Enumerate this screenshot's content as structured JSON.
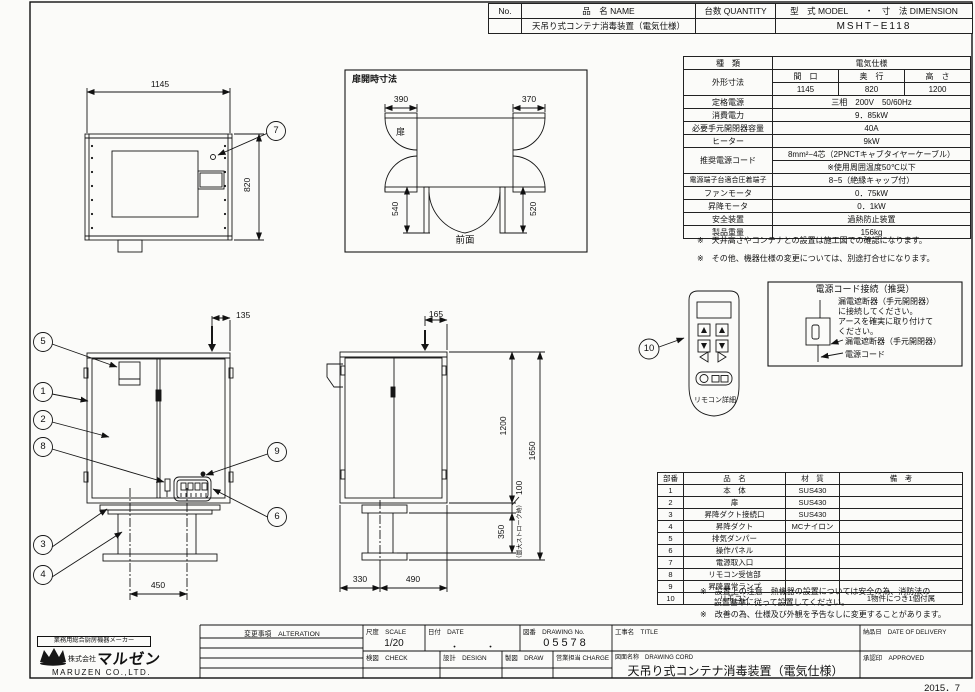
{
  "header": {
    "no_label": "No.",
    "name_label": "品　名 NAME",
    "name_value": "天吊り式コンテナ消毒装置（電気仕様）",
    "qty_label": "台数 QUANTITY",
    "model_label": "型　式 MODEL　　・　寸　法 DIMENSION",
    "model_value": "MSHT−E118"
  },
  "spec": {
    "kind_label": "種　類",
    "kind_value": "電気仕様",
    "size_label": "外形寸法",
    "size_cols": [
      "間　口",
      "奥　行",
      "高　さ"
    ],
    "size_values": [
      "1145",
      "820",
      "1200"
    ],
    "rows": [
      {
        "label": "定格電源",
        "value": "三相　200V　50/60Hz"
      },
      {
        "label": "消費電力",
        "value": "9．85kW"
      },
      {
        "label": "必要手元開閉器容量",
        "value": "40A"
      },
      {
        "label": "ヒーター",
        "value": "9kW"
      },
      {
        "label": "推奨電源コード",
        "value": "8mm²−4芯（2PNCTキャブタイヤーケーブル）",
        "value2": "※使用周囲温度50℃以下"
      },
      {
        "label": "電源端子台適合圧着端子",
        "value": "8−5（絶縁キャップ付）"
      },
      {
        "label": "ファンモータ",
        "value": "0．75kW"
      },
      {
        "label": "昇降モータ",
        "value": "0．1kW"
      },
      {
        "label": "安全装置",
        "value": "過熱防止装置"
      },
      {
        "label": "製品重量",
        "value": "156kg"
      }
    ],
    "notes": [
      "※　天井高さやコンテナとの設置は施工図での確認になります。",
      "※　その他、機器仕様の変更については、別途打合せになります。"
    ]
  },
  "power_box": {
    "title": "電源コード接続（推奨）",
    "line1": "漏電遮断器（手元開閉器）",
    "line2": "に接続してください。",
    "line3": "アースを確実に取り付けて",
    "line4": "ください。",
    "breaker_label": "漏電遮断器（手元開閉器）",
    "cord_label": "電源コード"
  },
  "remote": {
    "caption": "リモコン詳細"
  },
  "callouts": [
    "1",
    "2",
    "3",
    "4",
    "5",
    "6",
    "7",
    "8",
    "9",
    "10"
  ],
  "dims": {
    "top_view": {
      "width": "1145",
      "depth": "820"
    },
    "door_open": {
      "title": "扉開時寸法",
      "top_left": "390",
      "top_right": "370",
      "left": "540",
      "right": "520",
      "door": "扉",
      "caption": "前面"
    },
    "front_view": {
      "offset": "135",
      "duct_pitch": "450"
    },
    "side_view": {
      "offset": "165",
      "body_height": "1200",
      "overall_height": "1650",
      "flange": "100",
      "stroke": "350",
      "stroke_note": "（最大ストローク時）",
      "duct_left": "330",
      "duct_right": "490"
    }
  },
  "parts": {
    "headers": [
      "部番",
      "品　名",
      "材　質",
      "備　考"
    ],
    "rows": [
      {
        "no": "1",
        "name": "本　体",
        "material": "SUS430",
        "note": ""
      },
      {
        "no": "2",
        "name": "扉",
        "material": "SUS430",
        "note": ""
      },
      {
        "no": "3",
        "name": "昇降ダクト接続口",
        "material": "SUS430",
        "note": ""
      },
      {
        "no": "4",
        "name": "昇降ダクト",
        "material": "MCナイロン",
        "note": ""
      },
      {
        "no": "5",
        "name": "排気ダンパー",
        "material": "",
        "note": ""
      },
      {
        "no": "6",
        "name": "操作パネル",
        "material": "",
        "note": ""
      },
      {
        "no": "7",
        "name": "電源取入口",
        "material": "",
        "note": ""
      },
      {
        "no": "8",
        "name": "リモコン受信部",
        "material": "",
        "note": ""
      },
      {
        "no": "9",
        "name": "昇降異常ランプ",
        "material": "",
        "note": ""
      },
      {
        "no": "10",
        "name": "リモコン",
        "material": "",
        "note": "1物件につき1個付属"
      }
    ],
    "notes": [
      "※　設置上の注意　熱機器の設置については安全の為、消防法の",
      "設置基準に従って設置してください。",
      "※　改善の為、仕様及び外観を予告なしに変更することがあります。"
    ]
  },
  "title_block": {
    "maker_tagline": "業務用総合厨房機器メーカー",
    "company_prefix": "株式会社",
    "company_logo": "マルゼン",
    "company_en": "MARUZEN  CO.,LTD.",
    "alteration_label": "変更事項　ALTERATION",
    "scale_label": "尺度　SCALE",
    "scale_value": "1/20",
    "date_label": "日付　DATE",
    "date_value": "・　　　・",
    "dwg_no_label": "図番　DRAWING No.",
    "dwg_no_value": "05578",
    "project_label": "工事名　TITLE",
    "check_label": "検図　CHECK",
    "design_label": "設計　DESIGN",
    "draw_label": "製図　DRAW",
    "charge_label": "営業担当 CHARGE",
    "dwg_name_label": "図面名称　DRAWING CORD",
    "dwg_name_value": "天吊り式コンテナ消毒装置（電気仕様）",
    "delivery_label": "納品日　DATE OF DELIVERY",
    "approved_label": "承認印　APPROVED"
  },
  "issue_date": "2015．7"
}
